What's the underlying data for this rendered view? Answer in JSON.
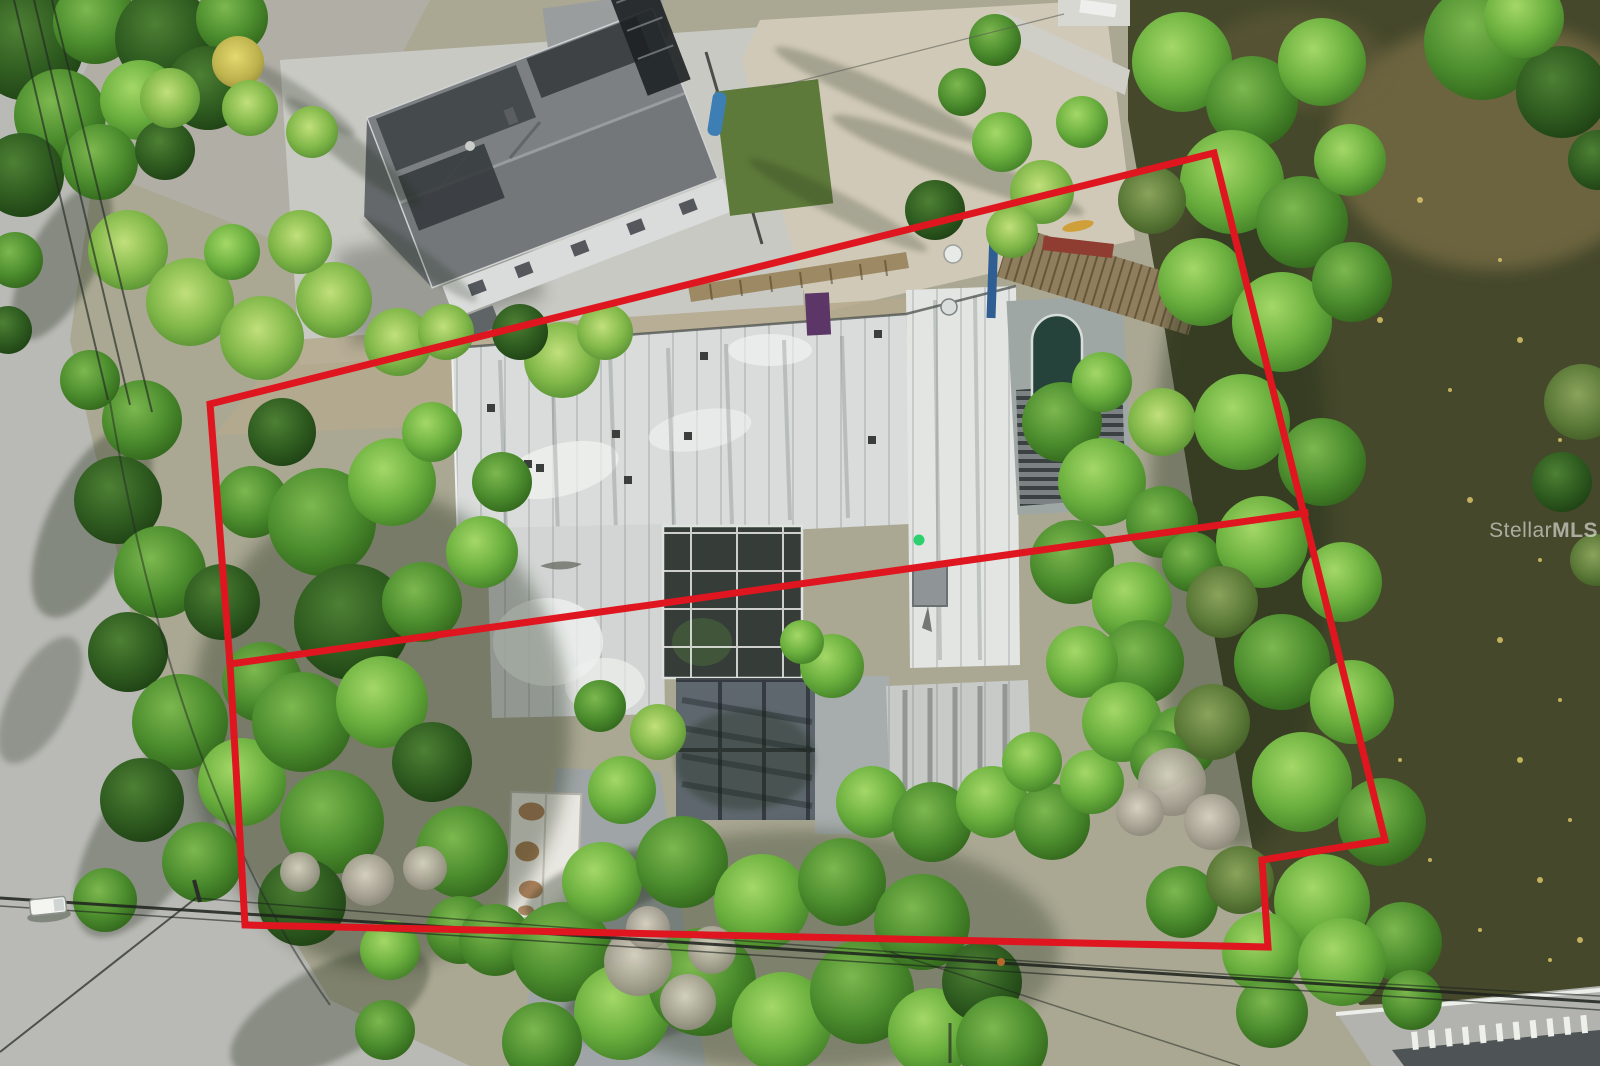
{
  "scene": {
    "type": "aerial-drone-photograph",
    "subject": "Overhead view of a waterfront lot with vacant flat-roof house, neighboring home, canal and tree canopy",
    "width_px": 1600,
    "height_px": 1066
  },
  "watermark": {
    "brand_first": "Stellar",
    "brand_second": "MLS",
    "color": "#ffffff"
  },
  "boundary": {
    "color": "#df161f",
    "stroke_width": 7,
    "outer_points": "210,404 1214,153 1385,840 1262,860 1268,947 245,925 230,664",
    "divider_points": "230,664 1305,513"
  },
  "palette": {
    "water": "#45482b",
    "water_shallow": "#7b6f46",
    "sand": "#d0c9b7",
    "road": "#b9b9b5",
    "concrete": "#c9c9c4",
    "main_roof_white": "#dcdedd",
    "neighbor_roof_gray": "#73777a",
    "screen_enclosure": "#363c38",
    "pool_water": "#25423b",
    "tree_bright": "#6aaf3e",
    "tree_mid": "#4c8d2e",
    "tree_dark": "#2f5c20",
    "dead_tree": "#a8a394",
    "wood_deck": "#8f7e5d",
    "shed_rust": "#a06b3f",
    "accent_purple": "#5c3166",
    "bridge_asphalt": "#4e5356"
  }
}
